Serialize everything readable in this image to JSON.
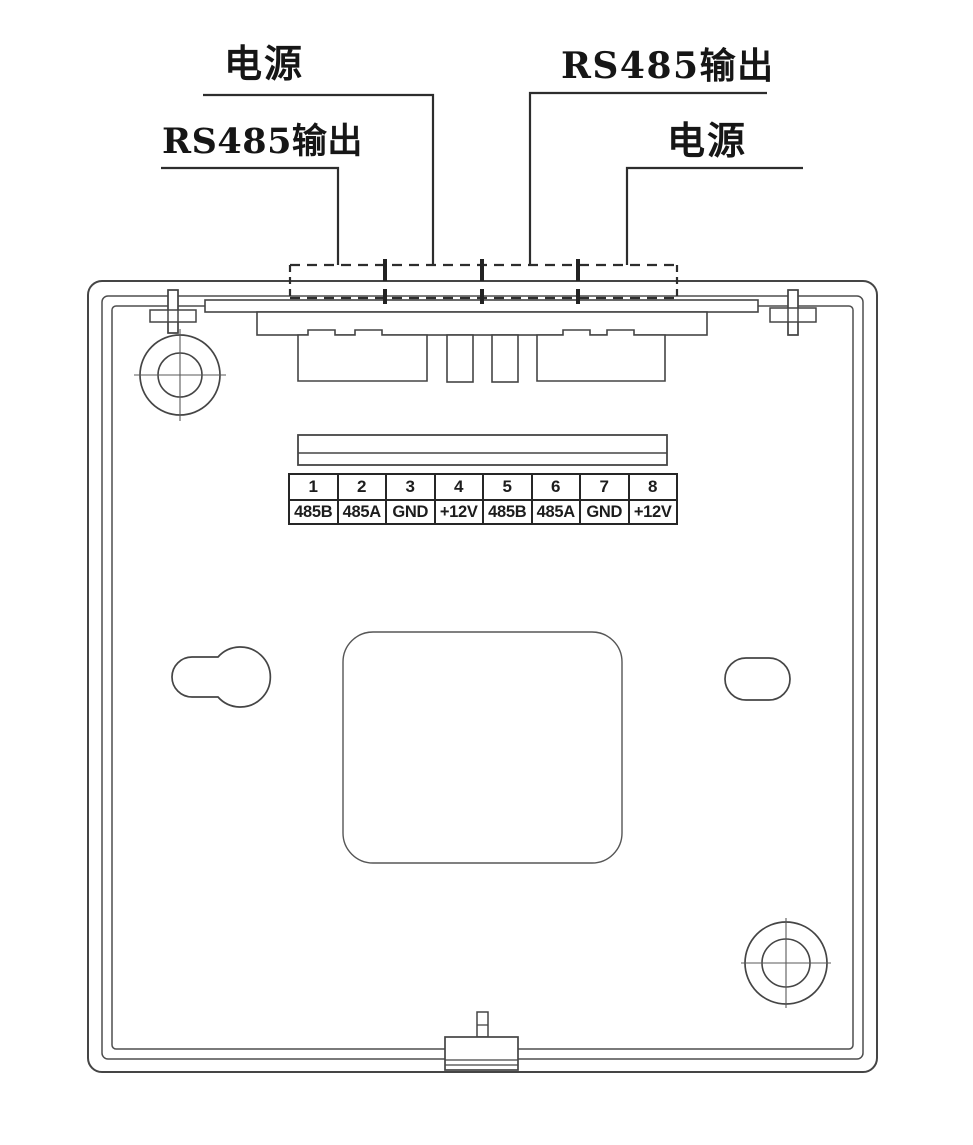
{
  "diagram": {
    "description_role": "device-rear-wiring-diagram",
    "callouts": {
      "power_top_left": "电源",
      "rs485_top_right": "RS485输出",
      "rs485_mid_left": "RS485输出",
      "power_mid_right": "电源"
    },
    "terminal_table": {
      "pins": [
        "1",
        "2",
        "3",
        "4",
        "5",
        "6",
        "7",
        "8"
      ],
      "signals": [
        "485B",
        "485A",
        "GND",
        "+12V",
        "485B",
        "485A",
        "GND",
        "+12V"
      ]
    },
    "colors": {
      "line": "#454545",
      "leader_line": "#2d2d2d",
      "table_border": "#262626",
      "text": "#161616",
      "background": "#ffffff"
    }
  }
}
